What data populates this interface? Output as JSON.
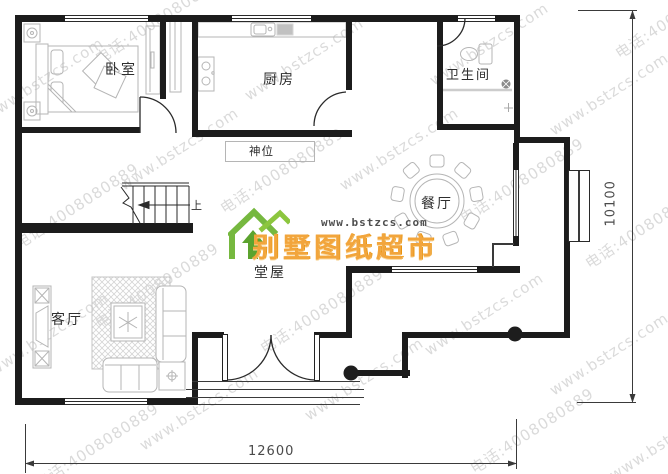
{
  "plan": {
    "rooms": {
      "bedroom": "卧室",
      "kitchen": "厨房",
      "bathroom": "卫生间",
      "shrine": "神位",
      "dining": "餐厅",
      "hall": "堂屋",
      "living": "客厅"
    },
    "stairs": {
      "up_label": "上"
    },
    "dimensions": {
      "bottom": "12600",
      "right": "10100"
    }
  },
  "logo": {
    "site": "www.bstzcs.com",
    "brand": "别墅图纸超市"
  },
  "watermark": {
    "url": "www.bstzcs.com",
    "phone": "电话:4008080889"
  },
  "colors": {
    "wall": "#1c1c1c",
    "furniture_line": "#b5b5b5",
    "logo_green": "#76b83f",
    "logo_orange": "#f2a53c",
    "watermark": "#bdbdbd",
    "shower_line": "#cccccc"
  }
}
